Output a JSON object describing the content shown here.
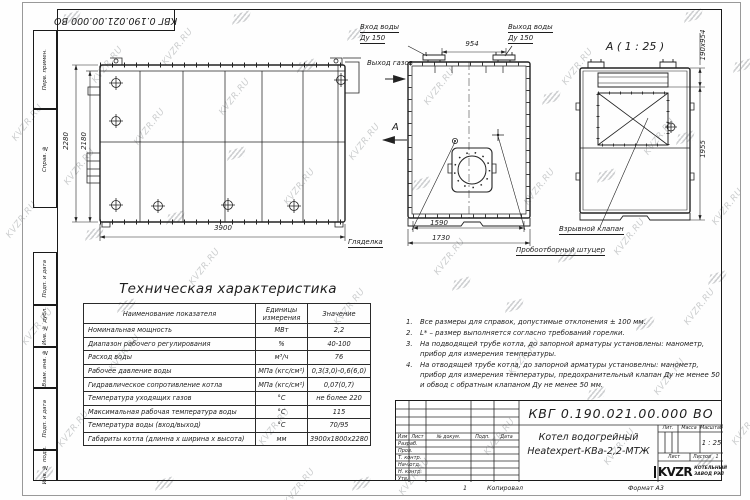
{
  "watermarks": {
    "text": "KVZR.RU",
    "text_positions": [
      [
        6,
        118
      ],
      [
        0,
        215
      ],
      [
        58,
        162
      ],
      [
        16,
        322
      ],
      [
        52,
        424
      ],
      [
        128,
        122
      ],
      [
        103,
        348
      ],
      [
        213,
        92
      ],
      [
        183,
        262
      ],
      [
        278,
        182
      ],
      [
        253,
        422
      ],
      [
        343,
        137
      ],
      [
        328,
        302
      ],
      [
        418,
        82
      ],
      [
        428,
        252
      ],
      [
        393,
        472
      ],
      [
        518,
        182
      ],
      [
        503,
        352
      ],
      [
        556,
        62
      ],
      [
        608,
        232
      ],
      [
        638,
        132
      ],
      [
        678,
        302
      ],
      [
        598,
        442
      ],
      [
        706,
        202
      ],
      [
        726,
        422
      ],
      [
        156,
        42
      ],
      [
        278,
        482
      ],
      [
        478,
        432
      ],
      [
        86,
        60
      ],
      [
        648,
        372
      ]
    ],
    "logo_positions": [
      [
        64,
        12
      ],
      [
        234,
        12
      ],
      [
        349,
        28
      ],
      [
        544,
        92
      ],
      [
        686,
        10
      ],
      [
        678,
        132
      ],
      [
        710,
        272
      ],
      [
        638,
        318
      ],
      [
        454,
        278
      ],
      [
        229,
        148
      ],
      [
        414,
        178
      ],
      [
        87,
        228
      ],
      [
        698,
        455
      ],
      [
        354,
        478
      ],
      [
        157,
        478
      ],
      [
        507,
        300
      ],
      [
        589,
        388
      ],
      [
        299,
        60
      ],
      [
        119,
        300
      ],
      [
        599,
        170
      ],
      [
        37,
        468
      ],
      [
        735,
        60
      ],
      [
        168,
        212
      ],
      [
        560,
        250
      ]
    ]
  },
  "frame": {
    "top_stamp": "КВГ 0.190.021.00.000 ВО",
    "left_labels": [
      "Перв. примен.",
      "Справ. №",
      "Подп. и дата",
      "Инв. № дубл.",
      "Взам. инв. №",
      "Подп. и дата",
      "Инв. № подл."
    ],
    "sheet_num": "1",
    "copied_label": "Копировал",
    "format_label": "Формат А3"
  },
  "views": {
    "side": {
      "dim_height_outer": "2280",
      "dim_height_inner": "2180",
      "dim_length": "3900"
    },
    "front": {
      "label_water_in": "Вход воды",
      "label_du_in": "Ду 150",
      "label_water_out": "Выход воды",
      "label_du_out": "Ду 150",
      "label_gas_out": "Выход газов",
      "view_letter": "А",
      "dim_flanges": "954",
      "dim_feet": "1590",
      "dim_base": "1730",
      "label_sight": "Гляделка",
      "label_sample": "Пробоотборный штуцер"
    },
    "section": {
      "title": "А ( 1 : 25 )",
      "dim_outlet": "190х954",
      "dim_height": "1955",
      "label_valve": "Взрывной клапан"
    }
  },
  "spec_table": {
    "title": "Техническая характеристика",
    "headers": [
      "Наименование показателя",
      "Единицы измерения",
      "Значение"
    ],
    "rows": [
      [
        "Номинальная мощность",
        "МВт",
        "2,2"
      ],
      [
        "Диапазон рабочего регулирования",
        "%",
        "40-100"
      ],
      [
        "Расход воды",
        "м³/ч",
        "76"
      ],
      [
        "Рабочее давление воды",
        "МПа (кгс/см²)",
        "0,3(3,0)-0,6(6,0)"
      ],
      [
        "Гидравлическое сопротивление котла",
        "МПа (кгс/см²)",
        "0,07(0,7)"
      ],
      [
        "Температура уходящих газов",
        "°С",
        "не более 220"
      ],
      [
        "Максимальная рабочая температура воды",
        "°С",
        "115"
      ],
      [
        "Температура воды (вход/выход)",
        "°С",
        "70/95"
      ],
      [
        "Габариты котла (длинна х ширина х высота)",
        "мм",
        "3900х1800х2280"
      ]
    ]
  },
  "notes": [
    {
      "num": "1.",
      "text": "Все размеры для справок, допустимые отклонения ± 100 мм."
    },
    {
      "num": "2.",
      "text": "L* – размер выполняется согласно требований горелки."
    },
    {
      "num": "3.",
      "text": "На подводящей трубе котла, до запорной арматуры установлены: манометр, прибор для измерения температуры."
    },
    {
      "num": "4.",
      "text": "На отводящей трубе котла, до запорной арматуры установелны: манометр, прибор для измерения температуры, предохранительный клапан Ду не менее 50 и обвод с обратным клапаном Ду не менее 50 мм."
    }
  ],
  "titleblock": {
    "doc_number": "КВГ 0.190.021.00.000 ВО",
    "product_line1": "Котел водогрейный",
    "product_line2": "Heatexpert-КВа-2,2-МТЖ",
    "lit_label": "Лит.",
    "mass_label": "Масса",
    "scale_label": "Масштаб",
    "scale_value": "1 : 25",
    "sheet_label": "Лист",
    "sheets_label": "Листов",
    "sheets_value": "1",
    "company_name": "KVZR",
    "company_sub1": "КОТЕЛЬНЫЙ",
    "company_sub2": "ЗАВОД РЭП",
    "cols": [
      "Изм",
      "Лист",
      "№ докум.",
      "Подп.",
      "Дата"
    ],
    "rows": [
      "Разраб.",
      "Пров.",
      "Т. контр.",
      "Нач.отд.",
      "Н. контр.",
      "Утв."
    ]
  }
}
